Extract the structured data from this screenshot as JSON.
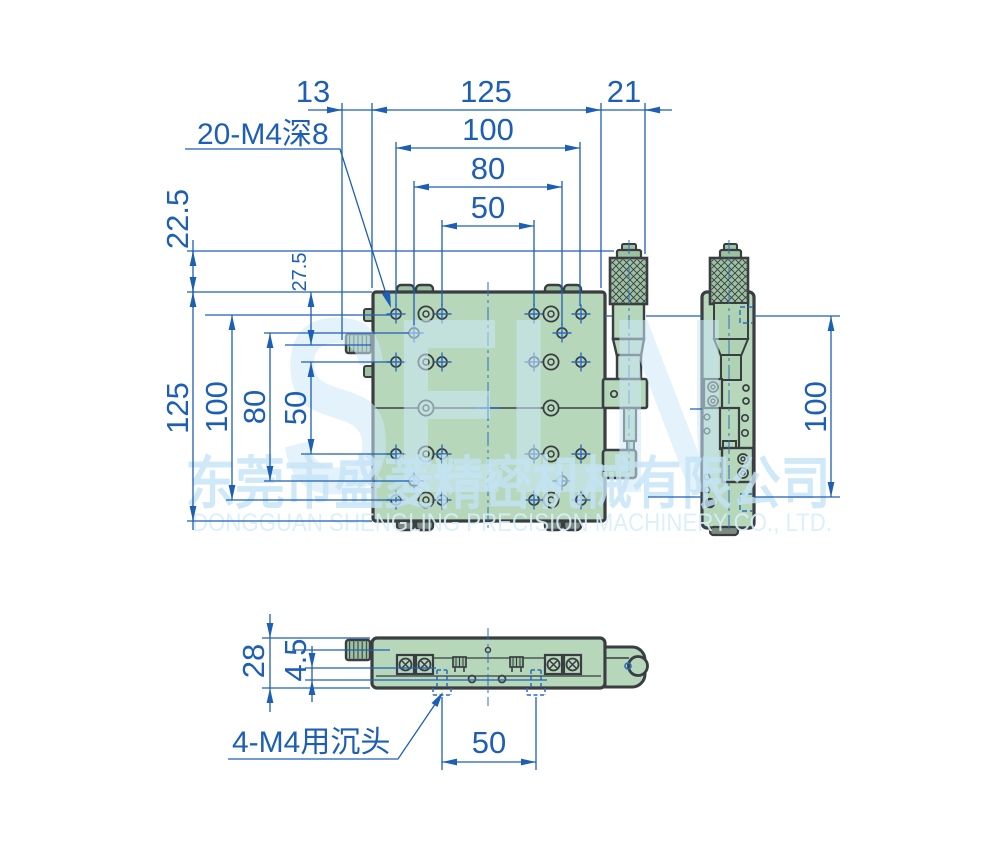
{
  "drawing": {
    "callouts": {
      "top_holes": "20-M4深8",
      "bottom_holes": "4-M4用沉头"
    },
    "dims": {
      "top_13": "13",
      "top_125": "125",
      "top_21": "21",
      "top_100": "100",
      "top_80": "80",
      "top_50": "50",
      "left_22_5": "22.5",
      "left_27_5": "27.5",
      "left_125": "125",
      "left_100": "100",
      "left_80": "80",
      "left_50": "50",
      "side_100": "100",
      "bottom_28": "28",
      "bottom_4_5": "4.5",
      "bottom_50": "50"
    },
    "watermark": {
      "brand": "SELN",
      "company_cn": "东莞市盛菱精密机械有限公司",
      "company_en": "DONGGUAN SHENGLING PRECISION MACHINERY CO., LTD."
    },
    "colors": {
      "dimension_blue": "#1d5fb5",
      "centerline_blue": "#2f6fc1",
      "outline_dark": "#3a3e42",
      "body_green": "#b6d7ba",
      "knob_green": "#9dc2a1",
      "watermark_blue": "#cde9f9"
    }
  }
}
